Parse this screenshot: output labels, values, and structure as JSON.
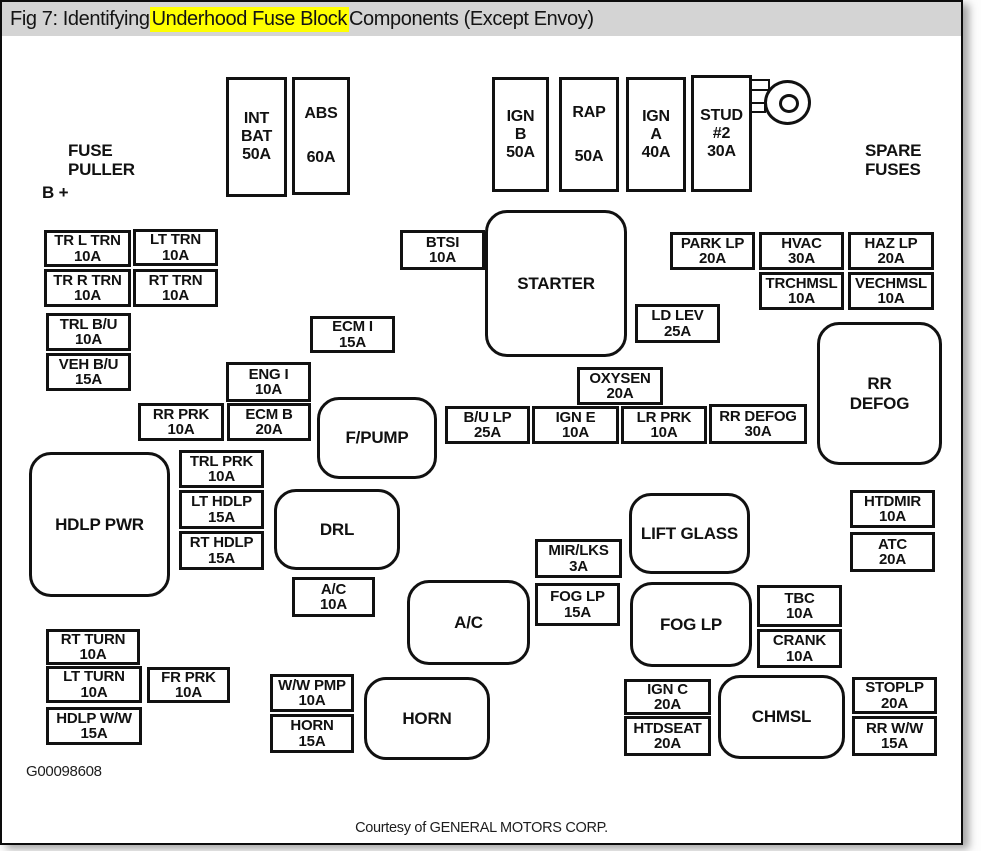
{
  "title": {
    "prefix": "Fig 7: Identifying ",
    "highlight": "Underhood Fuse Block",
    "suffix": " Components (Except Envoy)"
  },
  "colors": {
    "title_bar_bg": "#d4d4d4",
    "highlight_bg": "#ffff00",
    "ink": "#111111",
    "paper": "#ffffff"
  },
  "labels": {
    "fuse_puller": [
      "FUSE",
      "PULLER"
    ],
    "b_plus": "B +",
    "spare_fuses": [
      "SPARE",
      "FUSES"
    ],
    "figure_id": "G00098608",
    "courtesy": "Courtesy of GENERAL MOTORS CORP."
  },
  "fuses": [
    {
      "lines": [
        "INT",
        "BAT",
        "50A"
      ],
      "x": 224,
      "y": 75,
      "w": 61,
      "h": 120,
      "tall": true
    },
    {
      "lines": [
        "ABS",
        "60A"
      ],
      "x": 290,
      "y": 75,
      "w": 58,
      "h": 118,
      "tall": true,
      "spaced": true
    },
    {
      "lines": [
        "IGN",
        "B",
        "50A"
      ],
      "x": 490,
      "y": 75,
      "w": 57,
      "h": 115,
      "tall": true
    },
    {
      "lines": [
        "RAP",
        "50A"
      ],
      "x": 557,
      "y": 75,
      "w": 60,
      "h": 115,
      "tall": true,
      "spaced": true
    },
    {
      "lines": [
        "IGN",
        "A",
        "40A"
      ],
      "x": 624,
      "y": 75,
      "w": 60,
      "h": 115,
      "tall": true
    },
    {
      "lines": [
        "STUD",
        "#2",
        "30A"
      ],
      "x": 689,
      "y": 73,
      "w": 61,
      "h": 117,
      "tall": true
    },
    {
      "lines": [
        "TR L TRN",
        "10A"
      ],
      "x": 42,
      "y": 228,
      "w": 87,
      "h": 37
    },
    {
      "lines": [
        "LT TRN",
        "10A"
      ],
      "x": 131,
      "y": 227,
      "w": 85,
      "h": 37
    },
    {
      "lines": [
        "TR R TRN",
        "10A"
      ],
      "x": 42,
      "y": 267,
      "w": 87,
      "h": 38
    },
    {
      "lines": [
        "RT TRN",
        "10A"
      ],
      "x": 131,
      "y": 267,
      "w": 85,
      "h": 38
    },
    {
      "lines": [
        "TRL B/U",
        "10A"
      ],
      "x": 44,
      "y": 311,
      "w": 85,
      "h": 38
    },
    {
      "lines": [
        "VEH B/U",
        "15A"
      ],
      "x": 44,
      "y": 351,
      "w": 85,
      "h": 38
    },
    {
      "lines": [
        "BTSI",
        "10A"
      ],
      "x": 398,
      "y": 228,
      "w": 85,
      "h": 40
    },
    {
      "lines": [
        "ECM I",
        "15A"
      ],
      "x": 308,
      "y": 314,
      "w": 85,
      "h": 37
    },
    {
      "lines": [
        "ENG I",
        "10A"
      ],
      "x": 224,
      "y": 360,
      "w": 85,
      "h": 40
    },
    {
      "lines": [
        "RR PRK",
        "10A"
      ],
      "x": 136,
      "y": 401,
      "w": 86,
      "h": 38
    },
    {
      "lines": [
        "ECM B",
        "20A"
      ],
      "x": 225,
      "y": 401,
      "w": 84,
      "h": 38
    },
    {
      "lines": [
        "TRL PRK",
        "10A"
      ],
      "x": 177,
      "y": 448,
      "w": 85,
      "h": 38
    },
    {
      "lines": [
        "LT HDLP",
        "15A"
      ],
      "x": 177,
      "y": 488,
      "w": 85,
      "h": 39
    },
    {
      "lines": [
        "RT HDLP",
        "15A"
      ],
      "x": 177,
      "y": 529,
      "w": 85,
      "h": 39
    },
    {
      "lines": [
        "A/C",
        "10A"
      ],
      "x": 290,
      "y": 575,
      "w": 83,
      "h": 40
    },
    {
      "lines": [
        "LD LEV",
        "25A"
      ],
      "x": 633,
      "y": 302,
      "w": 85,
      "h": 39
    },
    {
      "lines": [
        "OXYSEN",
        "20A"
      ],
      "x": 575,
      "y": 365,
      "w": 86,
      "h": 38
    },
    {
      "lines": [
        "B/U LP",
        "25A"
      ],
      "x": 443,
      "y": 404,
      "w": 85,
      "h": 38
    },
    {
      "lines": [
        "IGN E",
        "10A"
      ],
      "x": 530,
      "y": 404,
      "w": 87,
      "h": 38
    },
    {
      "lines": [
        "LR PRK",
        "10A"
      ],
      "x": 619,
      "y": 404,
      "w": 86,
      "h": 38
    },
    {
      "lines": [
        "RR DEFOG",
        "30A"
      ],
      "x": 707,
      "y": 402,
      "w": 98,
      "h": 40
    },
    {
      "lines": [
        "PARK LP",
        "20A"
      ],
      "x": 668,
      "y": 230,
      "w": 85,
      "h": 38
    },
    {
      "lines": [
        "HVAC",
        "30A"
      ],
      "x": 757,
      "y": 230,
      "w": 85,
      "h": 38
    },
    {
      "lines": [
        "HAZ LP",
        "20A"
      ],
      "x": 846,
      "y": 230,
      "w": 86,
      "h": 38
    },
    {
      "lines": [
        "TRCHMSL",
        "10A"
      ],
      "x": 757,
      "y": 270,
      "w": 85,
      "h": 38
    },
    {
      "lines": [
        "VECHMSL",
        "10A"
      ],
      "x": 846,
      "y": 270,
      "w": 86,
      "h": 38
    },
    {
      "lines": [
        "MIR/LKS",
        "3A"
      ],
      "x": 533,
      "y": 537,
      "w": 87,
      "h": 39
    },
    {
      "lines": [
        "FOG LP",
        "15A"
      ],
      "x": 533,
      "y": 581,
      "w": 85,
      "h": 43
    },
    {
      "lines": [
        "HTDMIR",
        "10A"
      ],
      "x": 848,
      "y": 488,
      "w": 85,
      "h": 38
    },
    {
      "lines": [
        "ATC",
        "20A"
      ],
      "x": 848,
      "y": 530,
      "w": 85,
      "h": 40
    },
    {
      "lines": [
        "TBC",
        "10A"
      ],
      "x": 755,
      "y": 583,
      "w": 85,
      "h": 42
    },
    {
      "lines": [
        "CRANK",
        "10A"
      ],
      "x": 755,
      "y": 627,
      "w": 85,
      "h": 39
    },
    {
      "lines": [
        "RT TURN",
        "10A"
      ],
      "x": 44,
      "y": 627,
      "w": 94,
      "h": 36
    },
    {
      "lines": [
        "LT TURN",
        "10A"
      ],
      "x": 44,
      "y": 664,
      "w": 96,
      "h": 37
    },
    {
      "lines": [
        "FR PRK",
        "10A"
      ],
      "x": 145,
      "y": 665,
      "w": 83,
      "h": 36
    },
    {
      "lines": [
        "HDLP W/W",
        "15A"
      ],
      "x": 44,
      "y": 705,
      "w": 96,
      "h": 38
    },
    {
      "lines": [
        "W/W PMP",
        "10A"
      ],
      "x": 268,
      "y": 672,
      "w": 84,
      "h": 38
    },
    {
      "lines": [
        "HORN",
        "15A"
      ],
      "x": 268,
      "y": 712,
      "w": 84,
      "h": 39
    },
    {
      "lines": [
        "IGN C",
        "20A"
      ],
      "x": 622,
      "y": 677,
      "w": 87,
      "h": 36
    },
    {
      "lines": [
        "HTDSEAT",
        "20A"
      ],
      "x": 622,
      "y": 714,
      "w": 87,
      "h": 40
    },
    {
      "lines": [
        "STOPLP",
        "20A"
      ],
      "x": 850,
      "y": 675,
      "w": 85,
      "h": 37
    },
    {
      "lines": [
        "RR W/W",
        "15A"
      ],
      "x": 850,
      "y": 714,
      "w": 85,
      "h": 40
    }
  ],
  "relays": [
    {
      "lines": [
        "STARTER"
      ],
      "x": 483,
      "y": 208,
      "w": 142,
      "h": 147
    },
    {
      "lines": [
        "F/PUMP"
      ],
      "x": 315,
      "y": 395,
      "w": 120,
      "h": 82
    },
    {
      "lines": [
        "RR",
        "DEFOG"
      ],
      "x": 815,
      "y": 320,
      "w": 125,
      "h": 143
    },
    {
      "lines": [
        "HDLP PWR"
      ],
      "x": 27,
      "y": 450,
      "w": 141,
      "h": 145
    },
    {
      "lines": [
        "DRL"
      ],
      "x": 272,
      "y": 487,
      "w": 126,
      "h": 81
    },
    {
      "lines": [
        "A/C"
      ],
      "x": 405,
      "y": 578,
      "w": 123,
      "h": 85
    },
    {
      "lines": [
        "LIFT GLASS"
      ],
      "x": 627,
      "y": 491,
      "w": 121,
      "h": 81
    },
    {
      "lines": [
        "FOG LP"
      ],
      "x": 628,
      "y": 580,
      "w": 122,
      "h": 85
    },
    {
      "lines": [
        "HORN"
      ],
      "x": 362,
      "y": 675,
      "w": 126,
      "h": 83
    },
    {
      "lines": [
        "CHMSL"
      ],
      "x": 716,
      "y": 673,
      "w": 127,
      "h": 84
    }
  ]
}
